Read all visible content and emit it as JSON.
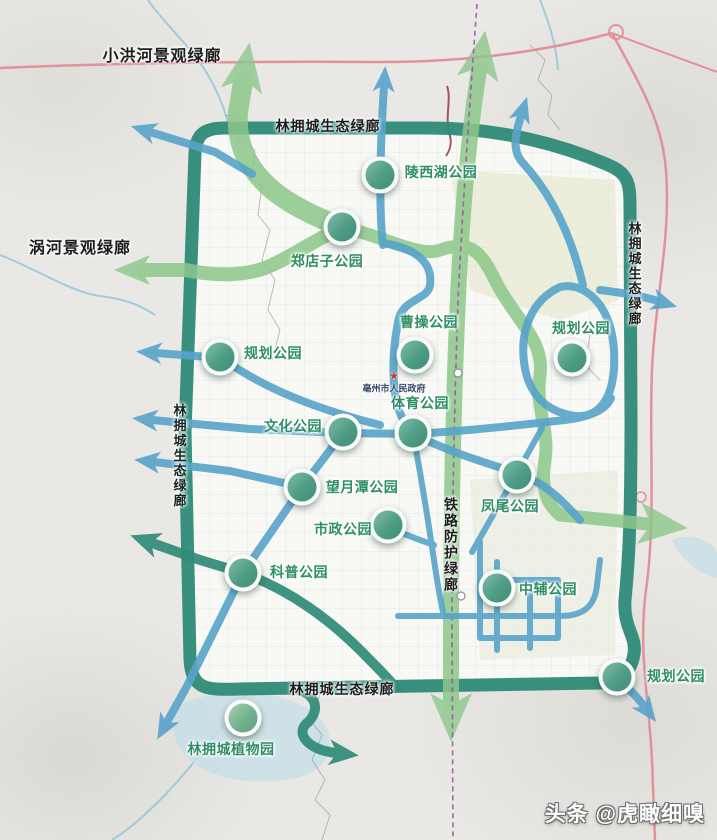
{
  "map": {
    "title_watermark": "头条 @虎瞰细嗅",
    "government": {
      "label": "亳州市人民政府",
      "icon": "star-icon"
    },
    "colors": {
      "ring_teal": "#2f8a77",
      "greenway": "#8cc78a",
      "blue_route": "#57a3c9",
      "road_pink": "#e2919b",
      "railway_purple": "#96519c",
      "park_fill": "#4f9c85",
      "park_label": "#2f8e66",
      "label_black": "#1c1c1c",
      "water": "#bfdde9"
    },
    "parks": [
      {
        "name": "陵西湖公园",
        "x": 380,
        "y": 175,
        "lx": 441,
        "ly": 172,
        "light": false
      },
      {
        "name": "郑店子公园",
        "x": 342,
        "y": 227,
        "lx": 327,
        "ly": 261,
        "light": false
      },
      {
        "name": "曹操公园",
        "x": 415,
        "y": 355,
        "lx": 429,
        "ly": 322,
        "light": false
      },
      {
        "name": "规划公园",
        "x": 220,
        "y": 357,
        "lx": 273,
        "ly": 353,
        "light": false
      },
      {
        "name": "体育公园",
        "x": 413,
        "y": 433,
        "lx": 420,
        "ly": 403,
        "light": false
      },
      {
        "name": "文化公园",
        "x": 343,
        "y": 432,
        "lx": 293,
        "ly": 426,
        "light": false
      },
      {
        "name": "望月潭公园",
        "x": 302,
        "y": 487,
        "lx": 362,
        "ly": 487,
        "light": false
      },
      {
        "name": "市政公园",
        "x": 388,
        "y": 525,
        "lx": 343,
        "ly": 529,
        "light": false
      },
      {
        "name": "科普公园",
        "x": 243,
        "y": 573,
        "lx": 299,
        "ly": 572,
        "light": false
      },
      {
        "name": "凤尾公园",
        "x": 517,
        "y": 475,
        "lx": 510,
        "ly": 506,
        "light": false
      },
      {
        "name": "规划公园",
        "x": 572,
        "y": 358,
        "lx": 581,
        "ly": 328,
        "light": false
      },
      {
        "name": "中辅公园",
        "x": 497,
        "y": 588,
        "lx": 548,
        "ly": 589,
        "light": false
      },
      {
        "name": "规划公园",
        "x": 617,
        "y": 677,
        "lx": 676,
        "ly": 676,
        "light": false
      },
      {
        "name": "林拥城植物园",
        "x": 243,
        "y": 718,
        "lx": 231,
        "ly": 749,
        "light": true
      }
    ],
    "corridor_labels": [
      {
        "text": "小洪河景观绿廊",
        "x": 162,
        "y": 54,
        "vertical": false,
        "color": "#1c1c1c",
        "size": 16
      },
      {
        "text": "涡河景观绿廊",
        "x": 80,
        "y": 246,
        "vertical": false,
        "color": "#1c1c1c",
        "size": 16
      },
      {
        "text": "林拥城生态绿廊",
        "x": 328,
        "y": 126,
        "vertical": false,
        "color": "#1c1c1c",
        "size": 14
      },
      {
        "text": "林拥城生态绿廊",
        "x": 179,
        "y": 456,
        "vertical": true,
        "color": "#12261f",
        "size": 13
      },
      {
        "text": "林拥城生态绿廊",
        "x": 634,
        "y": 274,
        "vertical": true,
        "color": "#1c1c1c",
        "size": 13
      },
      {
        "text": "铁路防护绿廊",
        "x": 451,
        "y": 545,
        "vertical": true,
        "color": "#1c1c1c",
        "size": 14
      },
      {
        "text": "林拥城生态绿廊",
        "x": 342,
        "y": 689,
        "vertical": false,
        "color": "#1c1c1c",
        "size": 14
      }
    ]
  }
}
